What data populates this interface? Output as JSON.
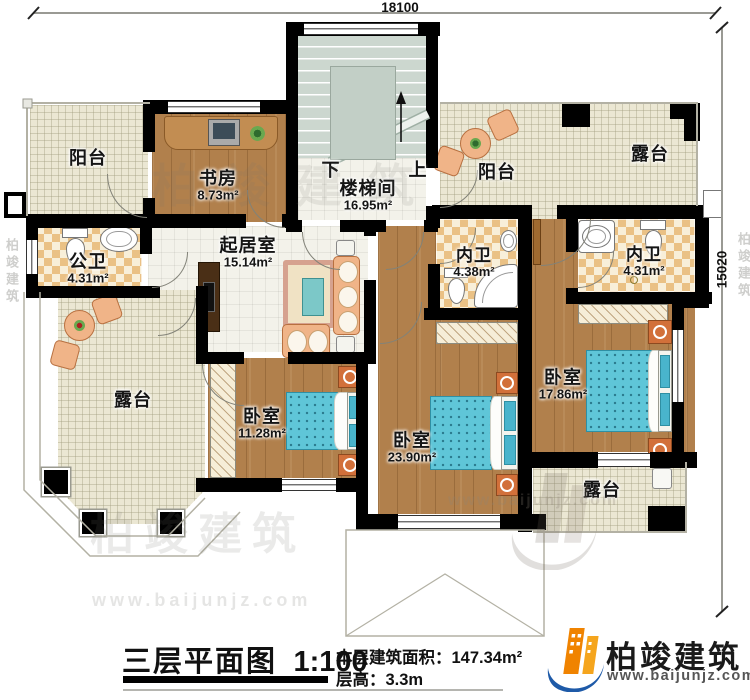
{
  "dimensions": {
    "top_width": "18100",
    "right_height": "15020"
  },
  "rooms": {
    "balcony_tl": {
      "name": "阳台"
    },
    "study": {
      "name": "书房",
      "area": "8.73m²"
    },
    "stairwell": {
      "name": "楼梯间",
      "area": "16.95m²",
      "down": "下",
      "up": "上"
    },
    "balcony_tr": {
      "name": "阳台"
    },
    "terrace_tr": {
      "name": "露台"
    },
    "public_bath": {
      "name": "公卫",
      "area": "4.31m²"
    },
    "living_room": {
      "name": "起居室",
      "area": "15.14m²"
    },
    "ensuite_bath_1": {
      "name": "内卫",
      "area": "4.38m²"
    },
    "ensuite_bath_2": {
      "name": "内卫",
      "area": "4.31m²"
    },
    "terrace_bl": {
      "name": "露台"
    },
    "bedroom_1": {
      "name": "卧室",
      "area": "11.28m²"
    },
    "bedroom_2": {
      "name": "卧室",
      "area": "23.90m²"
    },
    "bedroom_3": {
      "name": "卧室",
      "area": "17.86m²"
    },
    "terrace_br": {
      "name": "露台"
    }
  },
  "title_block": {
    "title": "三层平面图",
    "scale": "1:100",
    "floor_area": "本层建筑面积：147.34m²",
    "floor_height": "层高：3.3m"
  },
  "logo": {
    "name": "柏竣建筑",
    "website": "www.baijunjz.com"
  },
  "watermark": {
    "brand": "柏竣建筑",
    "site": "www.baijunjz.com"
  },
  "colors": {
    "wall": "#000000",
    "wood_floor": "#b1804c",
    "tile_outdoor": "#ebe7d3",
    "tile_indoor": "#f3f2ea",
    "bath_tile": "#eac185",
    "stair": "#ccd7cf",
    "bed_blue": "#5fc6d8",
    "furniture_peach": "#f0b488",
    "logo_orange": "#f08300",
    "logo_blue": "#1e5aa8"
  }
}
